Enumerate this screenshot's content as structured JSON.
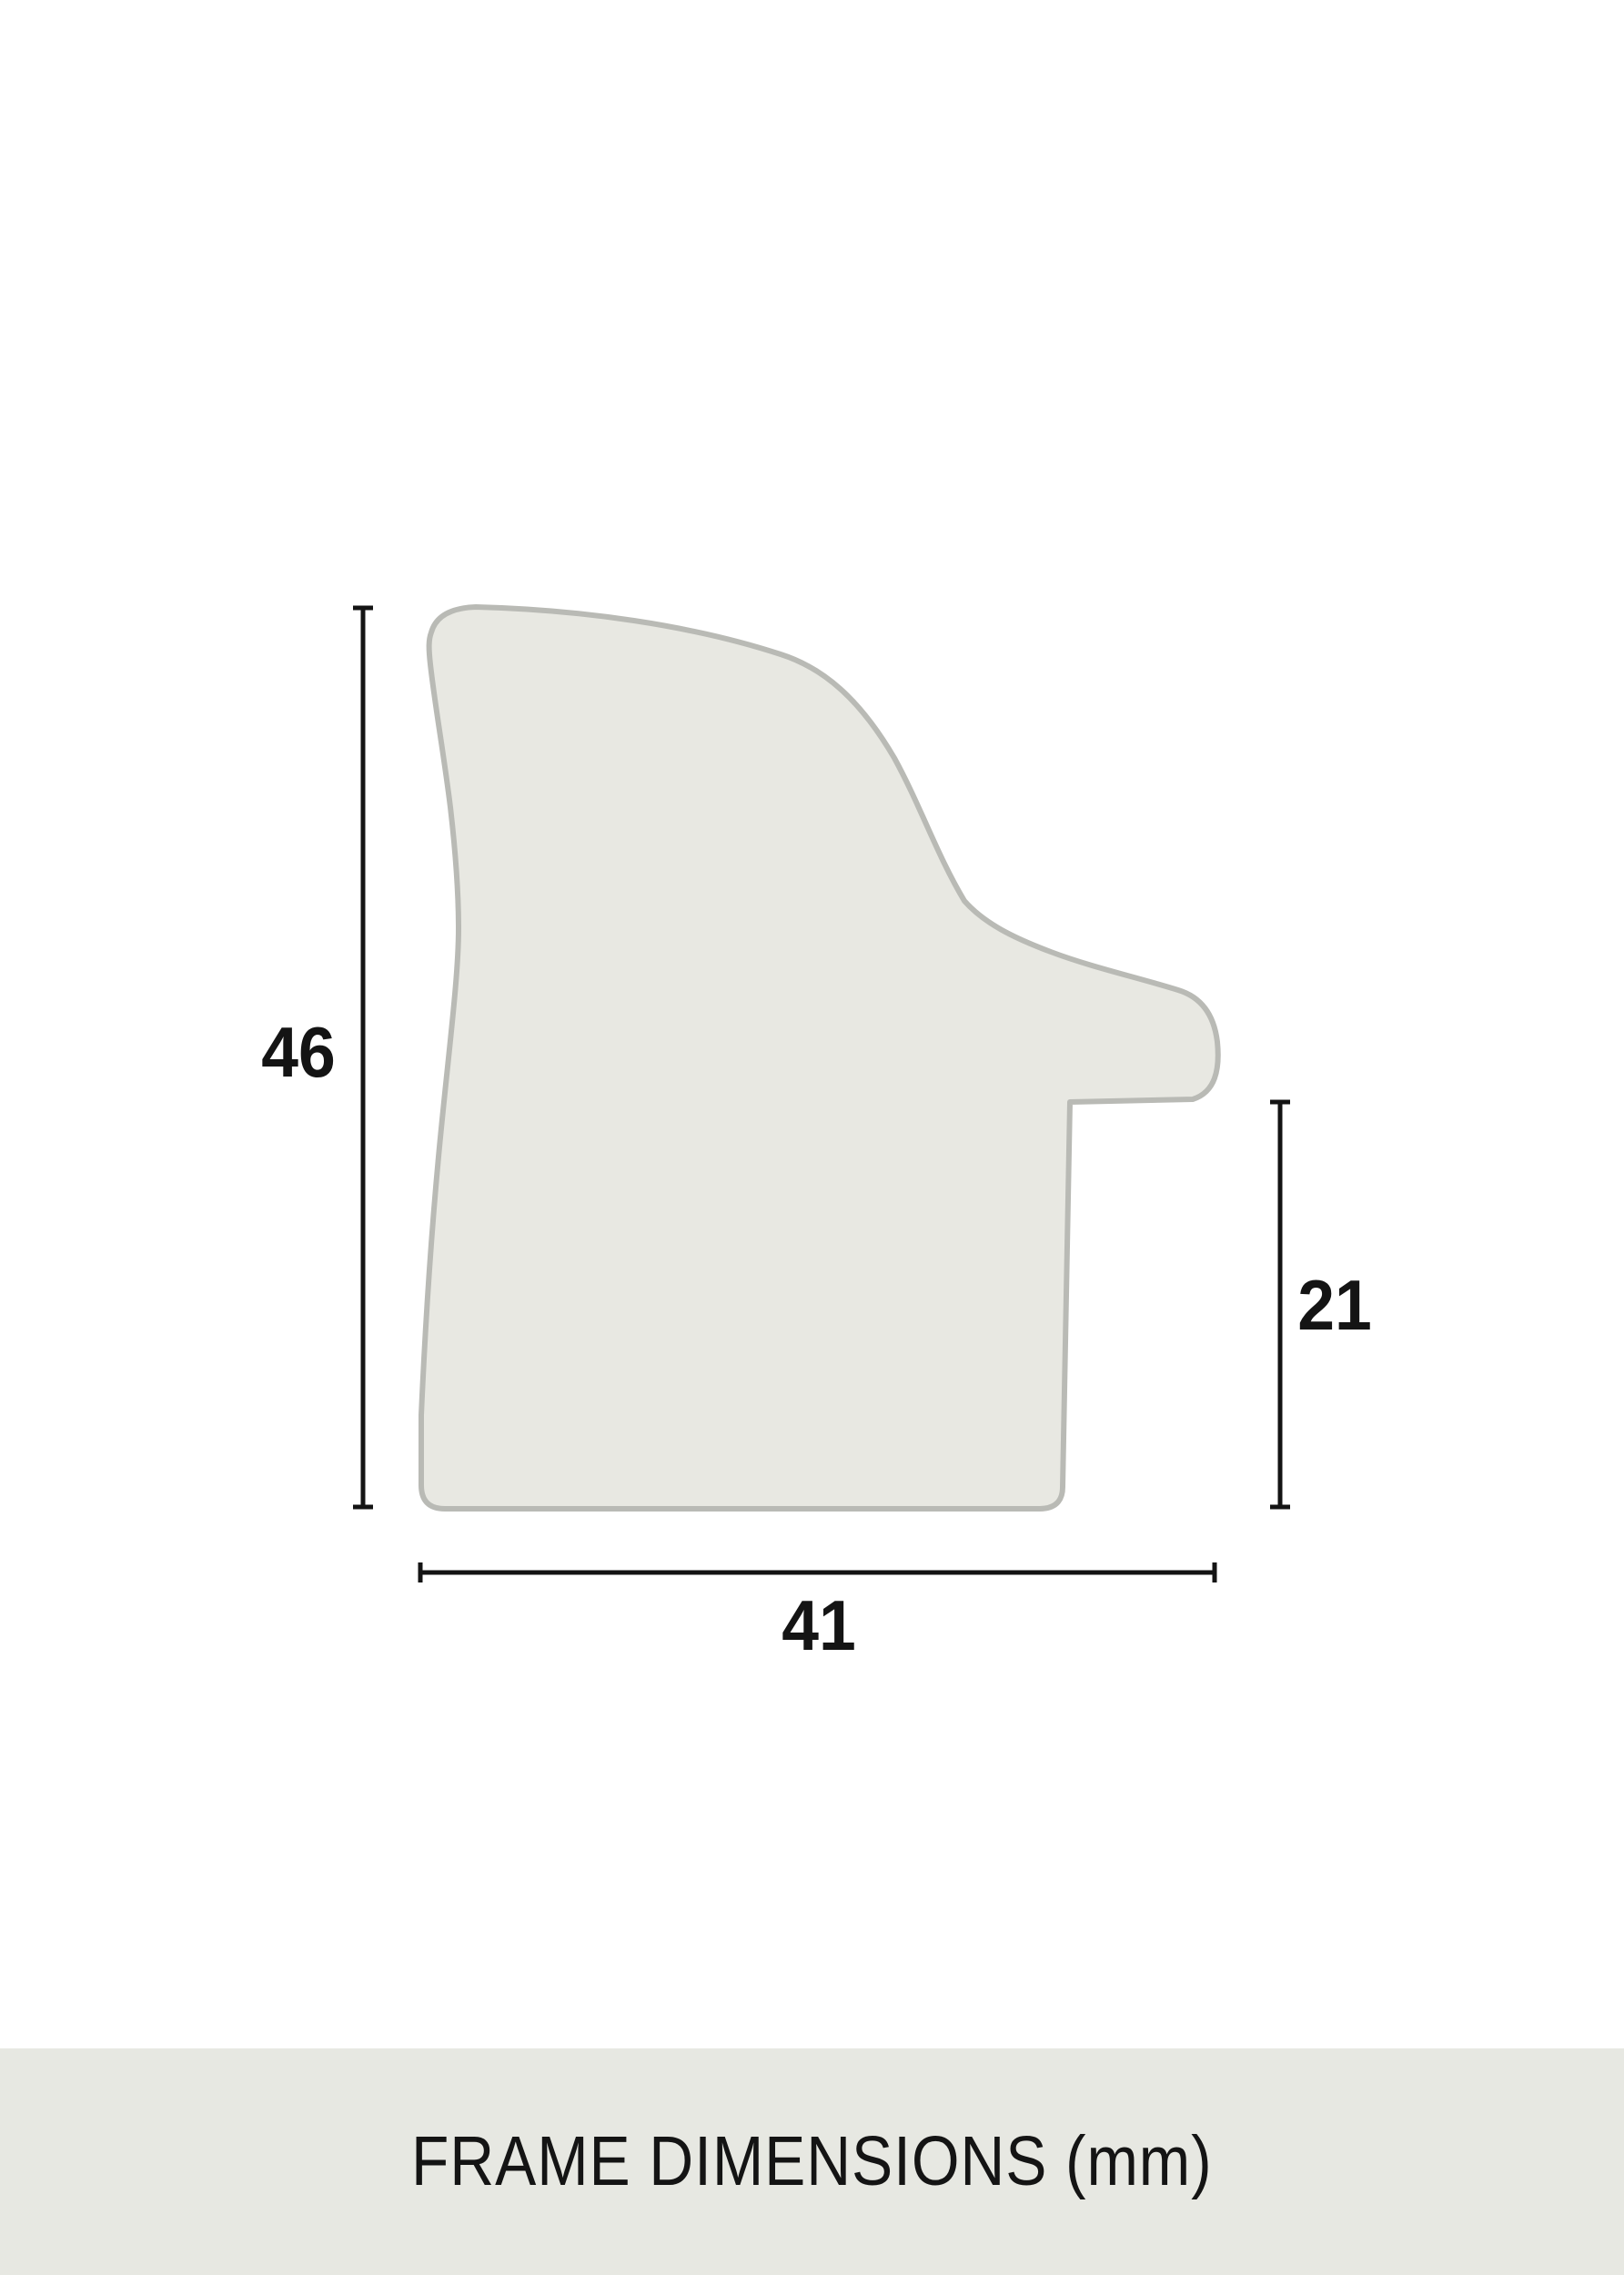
{
  "page": {
    "background": "#ffffff"
  },
  "profile": {
    "name": "frame moulding cross-section profile",
    "fill": "#e8e8e2",
    "stroke": "#b9bab5"
  },
  "dimensions": {
    "line_color": "#141414",
    "height": {
      "value": "46"
    },
    "rabbet": {
      "value": "21"
    },
    "width": {
      "value": "41"
    }
  },
  "footer": {
    "text": "FRAME DIMENSIONS (mm)",
    "background": "#e7e8e2",
    "text_color": "#141414"
  }
}
